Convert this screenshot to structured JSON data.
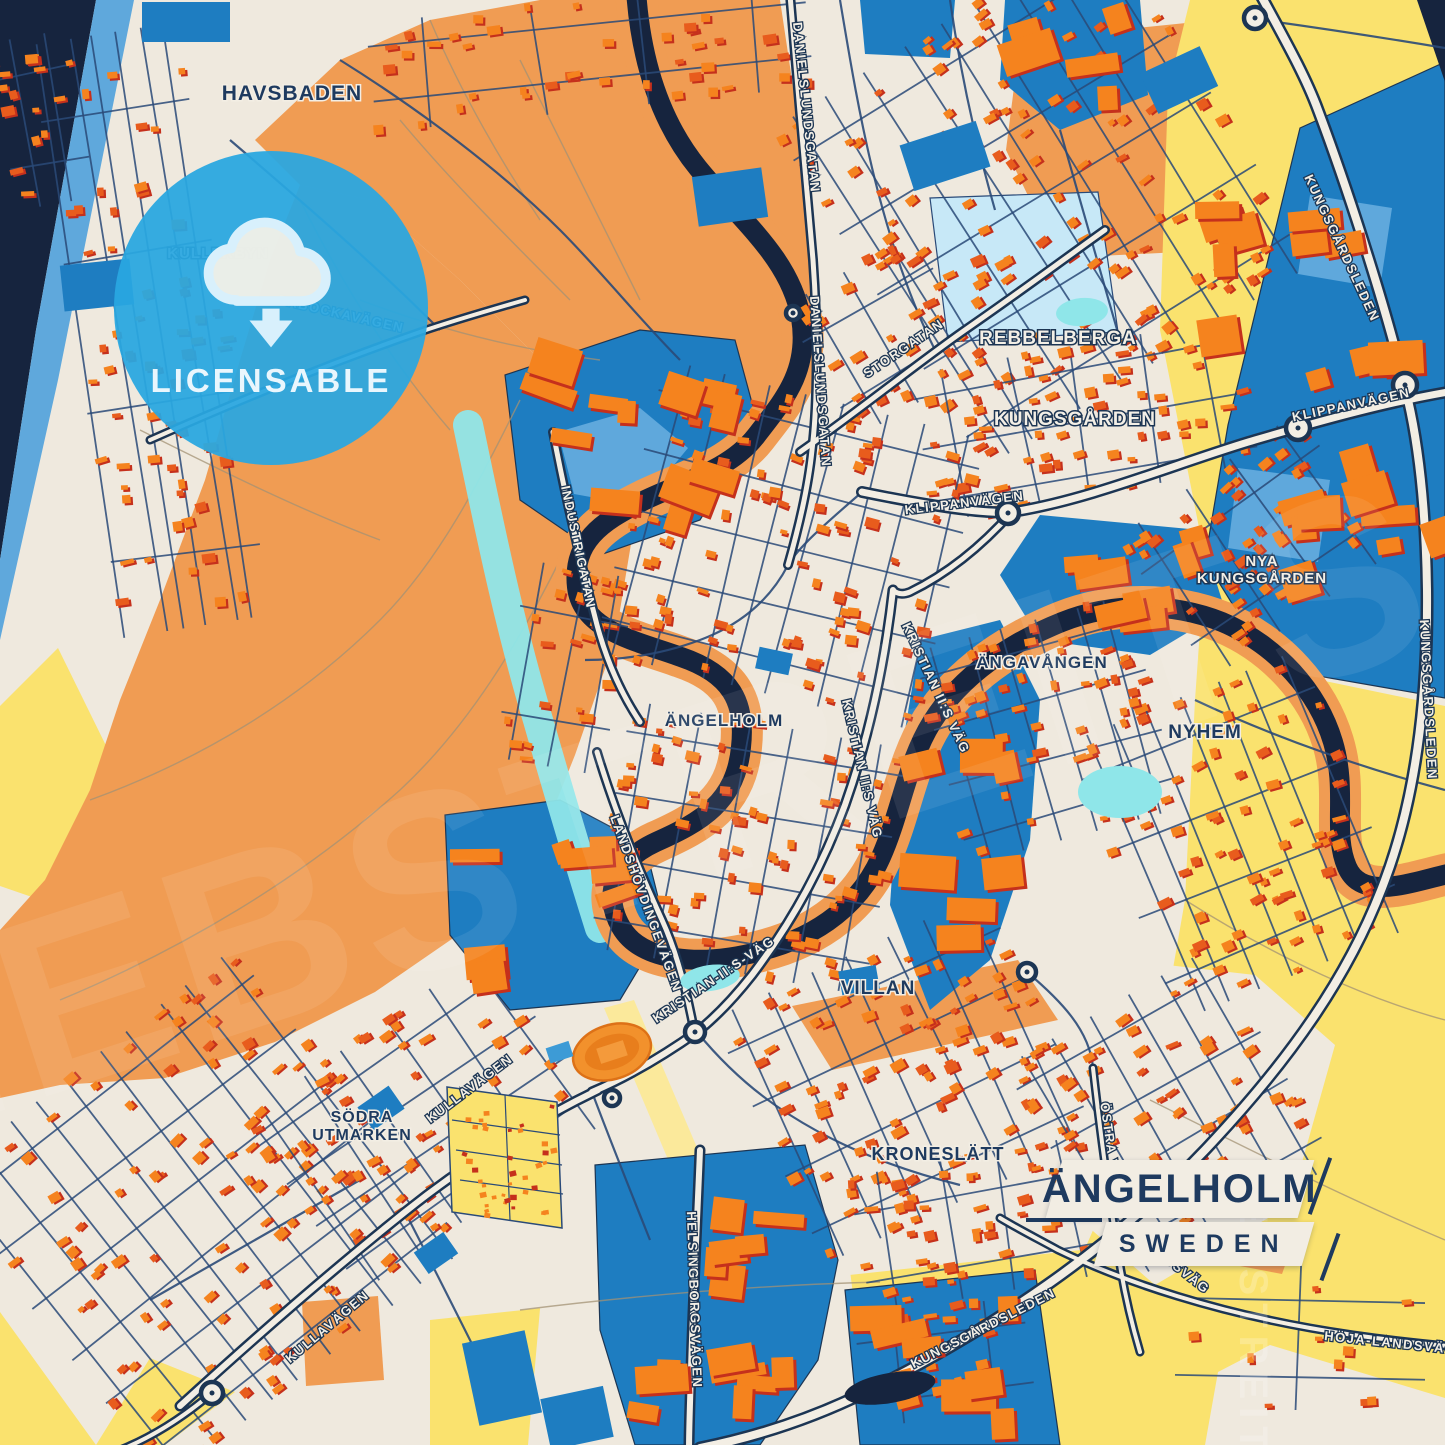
{
  "badge": {
    "label": "LICENSABLE"
  },
  "title": {
    "name": "ÄNGELHOLM",
    "country": "SWEDEN"
  },
  "watermark": {
    "main": "HEBSTREITS",
    "side": "HEBSTREIT"
  },
  "colors": {
    "cream": "#EFE9DE",
    "orange": "#F09C53",
    "yellow": "#FAE26E",
    "paleYellow": "#FBE99B",
    "blue": "#1E7DC1",
    "blueLight": "#5FA8DC",
    "paleBlue": "#C7E8F7",
    "cyan": "#8FE6E9",
    "navy": "#16243E",
    "roadFill": "#F3EEE4",
    "roadCasing": "#1C3553",
    "minor": "#2A4A78",
    "fieldPath": "#A39274",
    "houseTopA": "#F5831E",
    "houseTopB": "#E85C1D",
    "houseShadow": "#C5301C",
    "labelNavy": "#1E3A5F",
    "labelWhite": "#F3EFE6"
  },
  "map": {
    "regions": [
      {
        "name": "sea",
        "fill": "navy",
        "pts": "0,0 96,0 36,330 0,560"
      },
      {
        "name": "sea-strip",
        "fill": "blueLight",
        "pts": "96,0 134,0 58,380 0,640 0,560 36,330"
      },
      {
        "name": "beach-yellow",
        "fill": "yellow",
        "pts": "0,706 58,648 116,766 58,906 0,886"
      },
      {
        "name": "orange-left",
        "fill": "orange",
        "pts": "300,185 370,200 460,280 540,360 600,430 635,520 615,640 575,755 535,855 465,930 375,992 275,1042 165,1078 60,1085 0,1098 0,930 45,880 90,790 120,700 160,600 205,480 240,360 270,260"
      },
      {
        "name": "orange-park",
        "fill": "orange",
        "pts": "255,140 340,60 430,20 540,0 780,0 792,80 805,180 812,260 800,340 768,415 700,432 620,420 540,360 460,280 370,200 300,185"
      },
      {
        "name": "orange-ne",
        "fill": "orange",
        "pts": "1020,40 1235,18 1262,118 1180,252 1058,258 1006,150"
      },
      {
        "name": "yellow-topright",
        "fill": "yellow",
        "pts": "1190,0 1445,0 1445,64 1300,128 1228,425 1248,560 1205,558 1160,330 1168,90"
      },
      {
        "name": "yellow-right",
        "fill": "yellow",
        "pts": "1205,560 1272,670 1445,706 1445,1445 1060,1445 1080,1260 1150,1100 1185,900 1195,700"
      },
      {
        "name": "yellow-bottom",
        "fill": "yellow",
        "pts": "430,1320 1100,1248 1100,1445 430,1445"
      },
      {
        "name": "yellow-corner",
        "fill": "yellow",
        "pts": "0,1312 96,1445 0,1445"
      },
      {
        "name": "yellow-wedge",
        "fill": "yellow",
        "pts": "150,1358 235,1392 165,1445 96,1445"
      },
      {
        "name": "cream-pocket-east",
        "fill": "cream",
        "pts": "1035,950 1255,975 1335,1045 1290,1205 1155,1285 1040,1185 1008,1050"
      },
      {
        "name": "cream-pocket-bottom",
        "fill": "cream",
        "pts": "556,1128 830,1112 872,1445 528,1445"
      },
      {
        "name": "cream-pocket-br",
        "fill": "cream",
        "pts": "1270,1345 1445,1398 1445,1445 1205,1445 1218,1372"
      },
      {
        "name": "orange-band-stadium",
        "fill": "orange",
        "pts": "792,1006 1018,960 1058,1020 832,1070"
      },
      {
        "name": "orange-field-sw",
        "fill": "orange",
        "pts": "302,1302 378,1296 384,1380 306,1386"
      },
      {
        "name": "orange-parcel-se",
        "fill": "orange",
        "pts": "1248,1232 1294,1240 1282,1274 1240,1266"
      },
      {
        "name": "pale-stripe",
        "fill": "paleYellow",
        "pts": "604,1008 634,1000 716,1192 686,1202"
      },
      {
        "name": "pale-blue-field",
        "fill": "paleBlue",
        "stroke": "minor",
        "pts": "930,198 1098,192 1118,332 948,342"
      },
      {
        "name": "blue-topright",
        "fill": "blue",
        "stroke": "roadCasing",
        "pts": "1445,62 1445,698 1272,668 1205,560 1228,425 1300,128"
      },
      {
        "name": "blue-tr-parcel1",
        "fill": "blueLight",
        "pts": "1310,195 1392,208 1380,288 1298,274"
      },
      {
        "name": "blue-tr-parcel2",
        "fill": "blueLight",
        "pts": "1238,468 1330,480 1318,562 1228,548"
      },
      {
        "name": "blue-topcenter-a",
        "fill": "blue",
        "pts": "1005,0 1140,0 1148,95 1060,130 1000,80"
      },
      {
        "name": "blue-topcenter-b",
        "fill": "blue",
        "pts": "860,0 955,0 950,58 865,54"
      },
      {
        "name": "blue-industrigatan",
        "fill": "blue",
        "stroke": "roadCasing",
        "pts": "505,375 640,330 735,340 758,425 700,520 600,555 520,500"
      },
      {
        "name": "blue-ind-parcel",
        "fill": "blueLight",
        "pts": "558,432 640,408 688,448 640,506 574,494"
      },
      {
        "name": "blue-westblob",
        "fill": "blue",
        "stroke": "roadCasing",
        "pts": "445,815 560,800 645,845 665,925 620,1000 510,1010 450,935"
      },
      {
        "name": "blue-helsingborg",
        "fill": "blue",
        "stroke": "roadCasing",
        "pts": "595,1165 805,1145 838,1260 818,1360 760,1445 635,1445 600,1330"
      },
      {
        "name": "blue-br-parcels",
        "fill": "blue",
        "stroke": "roadCasing",
        "pts": "845,1290 1035,1270 1060,1445 860,1445"
      },
      {
        "name": "blue-center-right",
        "fill": "blue",
        "pts": "1040,515 1200,530 1225,610 1150,655 1040,640 1000,575"
      },
      {
        "name": "blue-corridor",
        "fill": "blue",
        "pts": "920,640 1000,620 1040,700 1030,840 990,960 930,1010 890,905 900,760"
      },
      {
        "name": "navy-corner-tr",
        "fill": "navy",
        "pts": "1417,0 1445,0 1445,82"
      }
    ],
    "field_paths": [
      "M90,800 C200,760 300,700 380,620 C440,560 480,480 520,400",
      "M60,1000 C180,950 300,880 400,790 C470,725 520,640 560,560",
      "M300,200 C340,280 390,360 450,430",
      "M140,430 C220,470 300,510 380,540",
      "M430,20 C460,90 500,160 540,220",
      "M400,120 C450,180 510,240 570,300",
      "M520,60 C560,140 600,220 640,300",
      "M360,300 C440,330 520,350 600,360",
      "M1150,1100 C1250,1150 1350,1200 1445,1240",
      "M520,1310 C640,1295 760,1285 880,1282",
      "M1185,900 C1280,960 1370,1000 1445,1020"
    ],
    "cyan_strip": "M468,425 C488,520 508,620 538,720 C558,790 578,858 600,928",
    "river": {
      "d": "M636,-10 C640,50 655,115 698,168 C742,222 790,258 801,318 C810,372 782,402 756,436 C729,471 681,482 641,502 C601,522 572,542 577,587 C582,632 641,642 681,657 C731,674 746,702 741,747 C736,802 701,822 656,842 C617,860 601,892 621,927 C641,962 701,967 761,951 C821,936 861,902 881,857 C901,812 907,762 932,722 C962,674 1012,642 1062,622 C1112,602 1172,602 1222,622 C1277,645 1318,692 1333,742 C1348,792 1332,832 1347,867 C1362,902 1412,882 1448,874",
      "bank_w": 42,
      "w": 20
    },
    "minor_roads": [
      "M340,60 C420,110 500,170 560,230 C600,270 640,320 680,360",
      "M230,140 C300,200 370,260 440,330",
      "M840,0 C850,60 860,120 875,180 C890,240 910,300 935,350",
      "M950,0 C960,70 975,140 995,210",
      "M1060,130 C1080,200 1100,270 1120,340",
      "M862,492 C830,520 800,545 788,565",
      "M697,1032 C720,1060 750,1090 790,1115 C840,1147 900,1170 960,1185",
      "M592,1092 C610,1140 630,1190 650,1240",
      "M1027,972 C1060,1000 1090,1030 1093,1068",
      "M405,1212 C430,1260 455,1310 480,1360",
      "M150,1300 C220,1260 290,1220 360,1180",
      "M1262,20 C1320,28 1385,38 1445,48",
      "M788,565 C770,600 740,625 700,640 C660,655 620,660 585,660",
      "M1195,700 C1280,740 1370,770 1445,790"
    ],
    "roads": [
      {
        "name": "kungsgardsleden-top",
        "d": "M1258,-10 C1285,40 1305,75 1318,110 C1350,195 1390,320 1408,400 C1420,452 1426,520 1427,590",
        "w": 13
      },
      {
        "name": "kungsgardsleden-right",
        "d": "M1427,590 C1428,700 1415,800 1385,880 C1350,975 1290,1060 1205,1150 C1110,1250 990,1330 870,1390 C800,1425 740,1440 700,1448",
        "w": 13
      },
      {
        "name": "klippanvagen",
        "d": "M862,492 C940,508 990,514 1012,512 C1090,500 1180,462 1255,440 C1330,418 1390,402 1448,392",
        "w": 12
      },
      {
        "name": "storgatan",
        "d": "M800,452 C860,410 915,365 965,330 C1020,292 1060,262 1105,230",
        "w": 10
      },
      {
        "name": "danielslundsgatan",
        "d": "M790,-5 C797,80 806,180 813,260 C818,330 818,400 812,450 C808,490 798,530 788,565",
        "w": 10
      },
      {
        "name": "kristian-ii-vag",
        "d": "M893,590 C884,670 868,740 845,805 C822,868 790,925 752,975 C730,1003 712,1020 697,1032 C660,1058 625,1078 592,1092",
        "w": 11
      },
      {
        "name": "kristian-north",
        "d": "M1012,512 C980,548 945,575 910,592 C900,596 895,592 893,590",
        "w": 10
      },
      {
        "name": "landshovdingevagen",
        "d": "M597,752 C615,812 638,868 662,920 C678,955 688,998 694,1030",
        "w": 10
      },
      {
        "name": "industrigatan",
        "d": "M553,432 C565,495 580,560 597,625 C607,662 622,695 640,722",
        "w": 10
      },
      {
        "name": "kullavagen",
        "d": "M180,1406 C250,1342 330,1272 405,1212 C470,1160 540,1118 598,1090",
        "w": 11
      },
      {
        "name": "kullavagen-west",
        "d": "M212,1393 C180,1420 150,1438 120,1450",
        "w": 9
      },
      {
        "name": "helsingborgsvagen",
        "d": "M700,1150 C697,1225 693,1300 691,1370 C690,1405 689,1430 689,1450",
        "w": 11
      },
      {
        "name": "ostra-vagen",
        "d": "M1093,1068 C1100,1130 1108,1190 1117,1245 C1122,1282 1130,1318 1140,1352",
        "w": 9
      },
      {
        "name": "hoja-landsvag",
        "d": "M1000,1218 C1020,1230 1040,1240 1058,1250 C1130,1285 1220,1312 1310,1328 C1355,1336 1405,1342 1448,1346",
        "w": 9
      },
      {
        "name": "pabockavagen",
        "d": "M150,440 C240,400 330,363 420,332 C455,320 490,310 525,300",
        "w": 9
      }
    ],
    "clusters": [
      [
        150,
        330,
        150,
        600,
        -9,
        60,
        6
      ],
      [
        590,
        55,
        440,
        110,
        -6,
        40,
        4
      ],
      [
        1045,
        195,
        390,
        400,
        -32,
        120,
        9
      ],
      [
        1085,
        420,
        330,
        150,
        -10,
        55,
        5
      ],
      [
        1255,
        545,
        220,
        170,
        -35,
        45,
        4
      ],
      [
        1048,
        730,
        220,
        220,
        -15,
        55,
        6
      ],
      [
        1240,
        835,
        250,
        300,
        -22,
        70,
        7
      ],
      [
        790,
        545,
        330,
        300,
        14,
        95,
        8
      ],
      [
        748,
        848,
        280,
        250,
        10,
        70,
        6
      ],
      [
        905,
        1078,
        300,
        270,
        -25,
        85,
        7
      ],
      [
        978,
        1225,
        240,
        140,
        -10,
        45,
        4
      ],
      [
        1170,
        1115,
        240,
        250,
        -30,
        60,
        6
      ],
      [
        200,
        1215,
        380,
        380,
        -38,
        105,
        10
      ],
      [
        425,
        1120,
        300,
        210,
        -35,
        55,
        6
      ],
      [
        565,
        668,
        110,
        200,
        10,
        22,
        3
      ],
      [
        945,
        1362,
        170,
        110,
        -8,
        20,
        2
      ],
      [
        42,
        120,
        80,
        170,
        -10,
        14,
        2
      ],
      [
        1300,
        1335,
        250,
        150,
        0,
        10,
        1
      ],
      [
        885,
        335,
        150,
        150,
        -30,
        26,
        3
      ]
    ],
    "big_clusters": [
      [
        1330,
        390,
        200,
        420,
        -10,
        22
      ],
      [
        630,
        440,
        190,
        140,
        12,
        12
      ],
      [
        718,
        1300,
        170,
        250,
        0,
        14
      ],
      [
        552,
        905,
        160,
        160,
        -10,
        8
      ],
      [
        950,
        1360,
        160,
        140,
        -5,
        8
      ],
      [
        1125,
        585,
        160,
        100,
        -10,
        7
      ],
      [
        1068,
        62,
        120,
        90,
        -10,
        5
      ],
      [
        962,
        820,
        100,
        240,
        -5,
        7
      ]
    ],
    "blue_rects": [
      [
        62,
        262,
        70,
        46,
        -6
      ],
      [
        142,
        2,
        88,
        40,
        0
      ],
      [
        695,
        172,
        70,
        50,
        -8
      ],
      [
        905,
        132,
        80,
        48,
        -18
      ],
      [
        1146,
        58,
        66,
        44,
        -25
      ],
      [
        470,
        1336,
        64,
        84,
        -12
      ],
      [
        545,
        1392,
        64,
        52,
        -12
      ],
      [
        418,
        1240,
        36,
        26,
        -35
      ],
      [
        840,
        968,
        38,
        24,
        -10
      ],
      [
        757,
        650,
        34,
        22,
        12
      ],
      [
        362,
        1094,
        38,
        28,
        -35
      ]
    ],
    "ponds": [
      {
        "type": "cyan",
        "cx": 710,
        "cy": 978,
        "rx": 30,
        "ry": 13,
        "rot": -8
      },
      {
        "type": "cyan",
        "cx": 1120,
        "cy": 792,
        "rx": 42,
        "ry": 26,
        "rot": 0
      },
      {
        "type": "cyan",
        "cx": 1082,
        "cy": 312,
        "rx": 26,
        "ry": 14,
        "rot": -5
      },
      {
        "type": "navy",
        "cx": 890,
        "cy": 1388,
        "rx": 46,
        "ry": 15,
        "rot": -10
      }
    ],
    "roundabouts": [
      [
        1255,
        18,
        11
      ],
      [
        1405,
        385,
        12
      ],
      [
        1298,
        428,
        12
      ],
      [
        1008,
        513,
        11
      ],
      [
        793,
        313,
        7
      ],
      [
        695,
        1032,
        10
      ],
      [
        612,
        1098,
        8
      ],
      [
        1027,
        972,
        9
      ],
      [
        212,
        1393,
        11
      ]
    ],
    "allotment": {
      "poly": "447,1087 557,1102 562,1228 452,1212",
      "lines": [
        "452,1120 560,1135",
        "456,1150 562,1165",
        "460,1180 563,1194",
        "505,1095 510,1220"
      ],
      "dots": 38
    },
    "stadium": {
      "cx": 612,
      "cy": 1052,
      "rot": -18
    },
    "area_labels": [
      {
        "t": "HAVSBADEN",
        "x": 292,
        "y": 100,
        "s": 21,
        "c": "navy"
      },
      {
        "t": "KULLERBYN",
        "x": 218,
        "y": 258,
        "s": 15,
        "c": "white"
      },
      {
        "t": "REBBELBERGA",
        "x": 1058,
        "y": 344,
        "s": 19,
        "c": "white"
      },
      {
        "t": "KUNGSGÅRDEN",
        "x": 1075,
        "y": 425,
        "s": 19,
        "c": "white"
      },
      {
        "lines": [
          "NYA",
          "KUNGSGÅRDEN"
        ],
        "x": 1262,
        "y": 566,
        "s": 15,
        "c": "white"
      },
      {
        "t": "ÄNGAVÅNGEN",
        "x": 1042,
        "y": 668,
        "s": 17,
        "c": "navy"
      },
      {
        "t": "NYHEM",
        "x": 1205,
        "y": 738,
        "s": 19,
        "c": "navy"
      },
      {
        "t": "ÄNGELHOLM",
        "x": 724,
        "y": 726,
        "s": 17,
        "c": "navy"
      },
      {
        "t": "VILLAN",
        "x": 878,
        "y": 994,
        "s": 19,
        "c": "navy"
      },
      {
        "t": "KRONESLÄTT",
        "x": 938,
        "y": 1160,
        "s": 18,
        "c": "navy"
      },
      {
        "lines": [
          "SÖDRA",
          "UTMARKEN"
        ],
        "x": 362,
        "y": 1122,
        "s": 16,
        "c": "navy"
      }
    ],
    "road_labels": [
      {
        "t": "DANIELSLUNDSGATAN",
        "x": 802,
        "y": 108,
        "r": 84
      },
      {
        "t": "DANIELSLUNDSGATAN",
        "x": 816,
        "y": 382,
        "r": 86
      },
      {
        "t": "STORGATAN",
        "x": 906,
        "y": 352,
        "r": -34
      },
      {
        "t": "KLIPPANVÄGEN",
        "x": 965,
        "y": 507,
        "r": -7
      },
      {
        "t": "KLIPPANVÄGEN",
        "x": 1352,
        "y": 409,
        "r": -12
      },
      {
        "t": "KUNGSGÅRDSLEDEN",
        "x": 1338,
        "y": 250,
        "r": 65
      },
      {
        "t": "KUNGSGÅRDSLEDEN",
        "x": 1424,
        "y": 700,
        "r": 87
      },
      {
        "t": "KUNGSGÅRDSLEDEN",
        "x": 985,
        "y": 1332,
        "r": -27
      },
      {
        "t": "INDUSTRIGATAN",
        "x": 574,
        "y": 548,
        "r": 78
      },
      {
        "t": "KRISTIAN II:S VÄG",
        "x": 858,
        "y": 770,
        "r": 77
      },
      {
        "t": "KRISTIAN-II:S-VÄG",
        "x": 716,
        "y": 983,
        "r": -34
      },
      {
        "t": "KRISTIAN II:S VÄG",
        "x": 932,
        "y": 690,
        "r": 65
      },
      {
        "t": "LANDSHÖVDINGEVÄGEN",
        "x": 642,
        "y": 905,
        "r": 70
      },
      {
        "t": "KULLAVÄGEN",
        "x": 330,
        "y": 1330,
        "r": -40
      },
      {
        "t": "KULLAVÄGEN",
        "x": 472,
        "y": 1092,
        "r": -37
      },
      {
        "t": "HELSINGBORGSVÄGEN",
        "x": 690,
        "y": 1300,
        "r": 88
      },
      {
        "t": "ÖSTRA VÄGEN",
        "x": 1108,
        "y": 1158,
        "r": 82
      },
      {
        "t": "HÖJA-LANDSVÄG",
        "x": 1390,
        "y": 1347,
        "r": 6
      },
      {
        "t": "LANDSVÄG",
        "x": 1172,
        "y": 1268,
        "r": 38
      },
      {
        "t": "PÅBOCKAVÄGEN",
        "x": 340,
        "y": 318,
        "r": 13
      }
    ]
  }
}
